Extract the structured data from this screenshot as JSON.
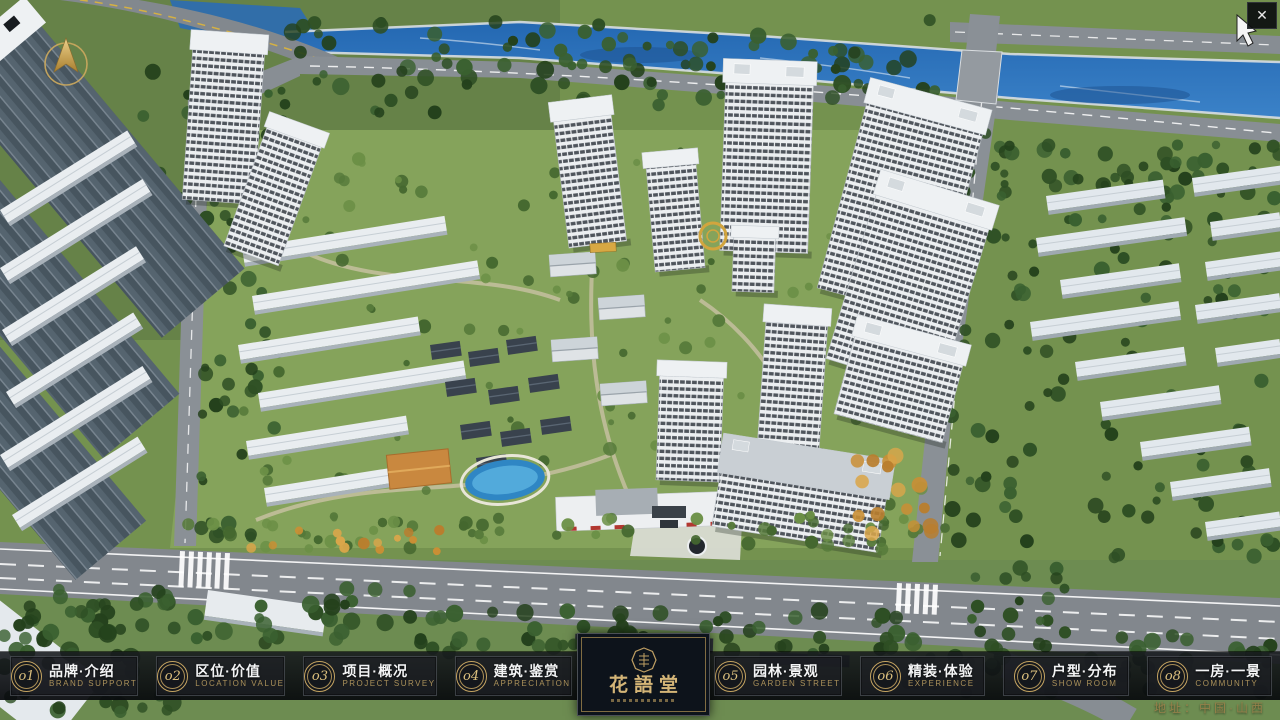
{
  "nav": {
    "items": [
      {
        "number": "o1",
        "title": "品牌·介绍",
        "subtitle": "BRAND SUPPORT"
      },
      {
        "number": "o2",
        "title": "区位·价值",
        "subtitle": "LOCATION VALUE"
      },
      {
        "number": "o3",
        "title": "项目·概况",
        "subtitle": "PROJECT SURVEY"
      },
      {
        "number": "o4",
        "title": "建筑·鉴赏",
        "subtitle": "APPRECIATION"
      },
      {
        "number": "o5",
        "title": "园林·景观",
        "subtitle": "GARDEN STREET"
      },
      {
        "number": "o6",
        "title": "精装·体验",
        "subtitle": "EXPERIENCE"
      },
      {
        "number": "o7",
        "title": "户型·分布",
        "subtitle": "SHOW ROOM"
      },
      {
        "number": "o8",
        "title": "一房·一景",
        "subtitle": "COMMUNITY"
      }
    ],
    "logo": {
      "title": "花語堂"
    }
  },
  "footer": {
    "address": "地址：中国·山西"
  },
  "icons": {
    "close": "✕",
    "compass": "north-compass-arrow",
    "cursor": "mouse-pointer"
  },
  "colors": {
    "gold": "#c6a562",
    "bar_bg": "#14171c",
    "river": "#2a6cb5",
    "grass": "#74924f",
    "road": "#82878d"
  }
}
